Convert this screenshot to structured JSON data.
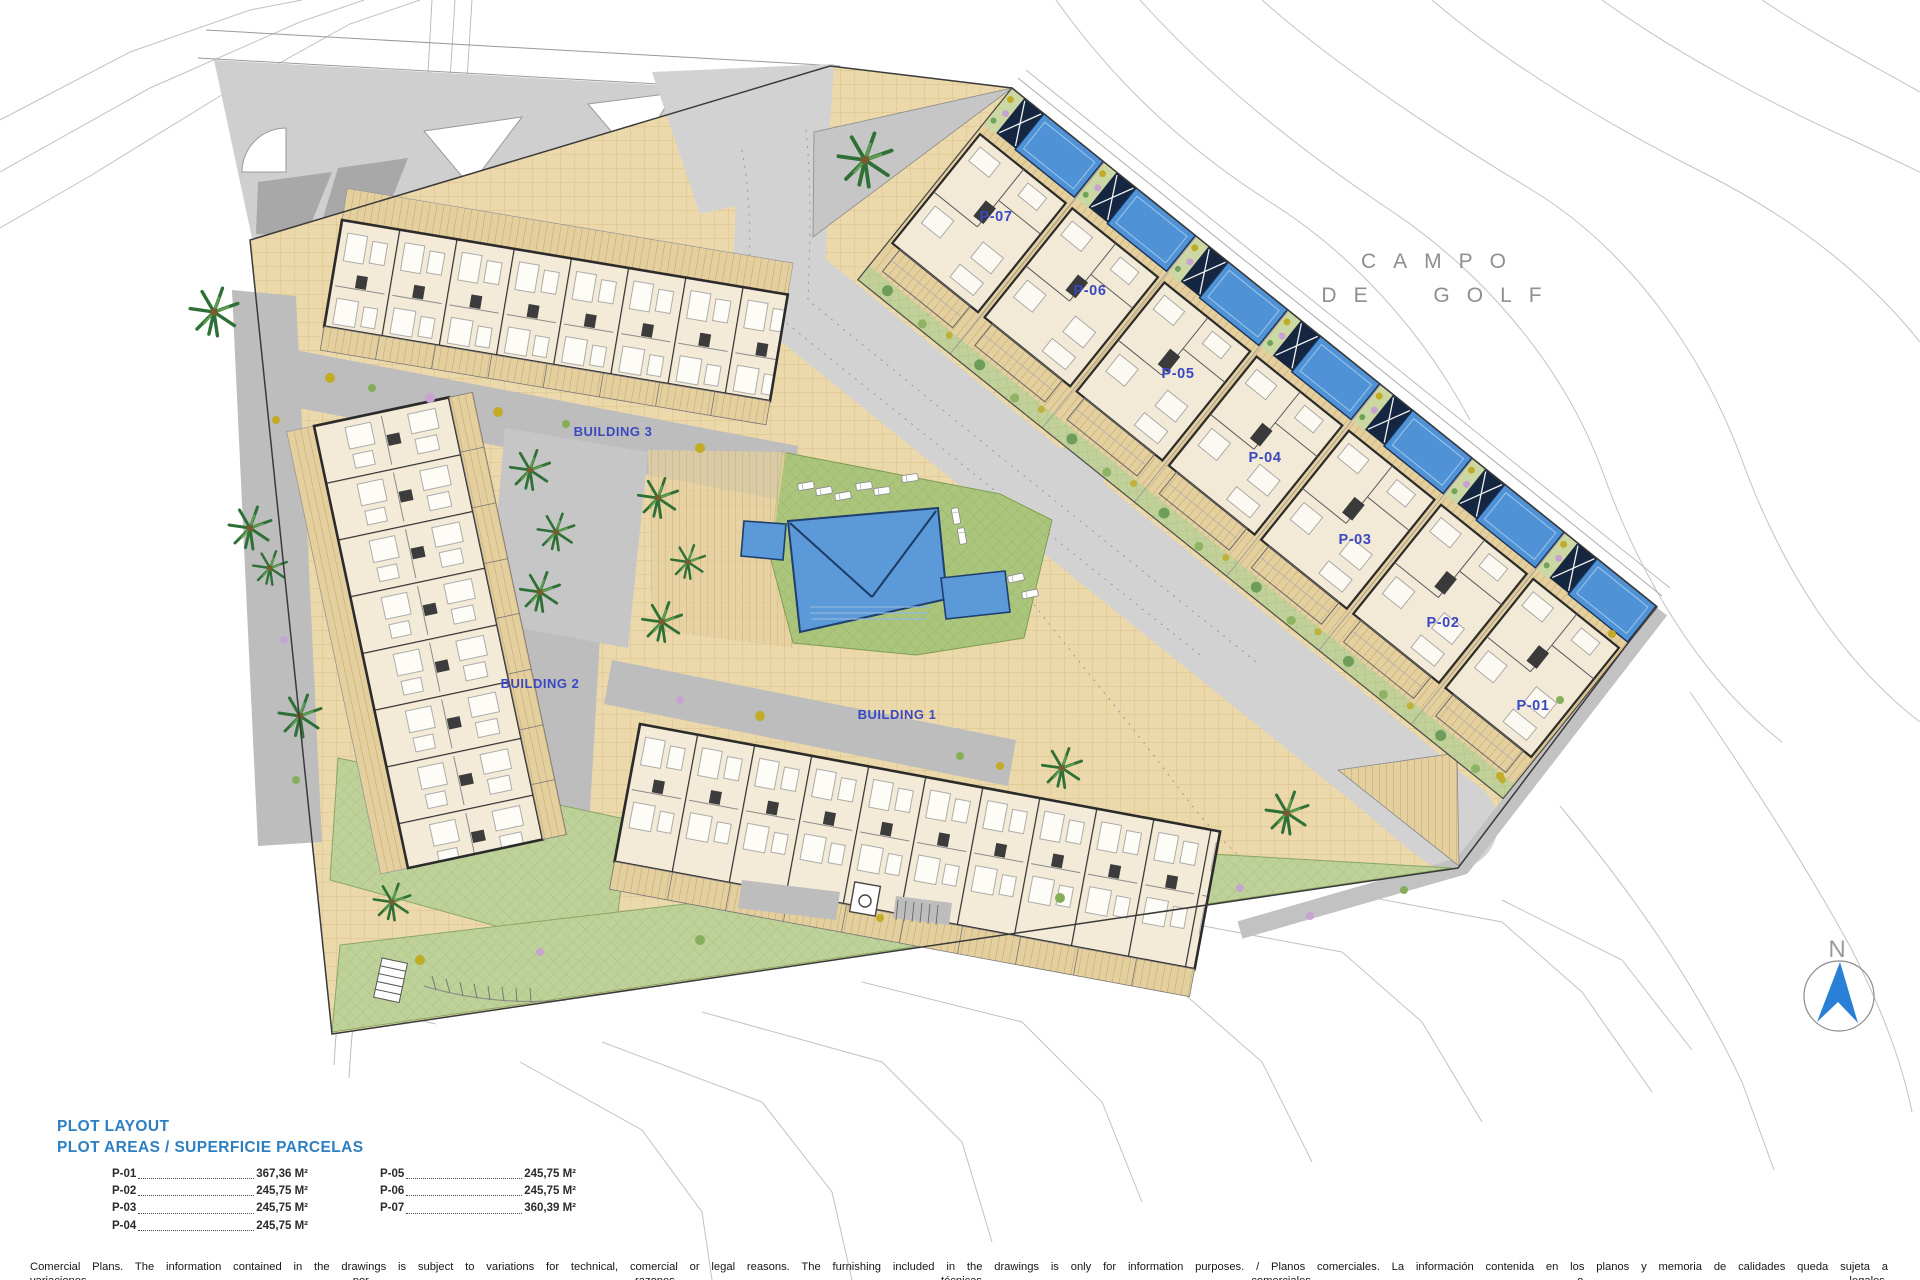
{
  "plan": {
    "golf_area_label": {
      "line1": "CAMPO",
      "line2": "DE GOLF"
    },
    "north": {
      "label": "N"
    },
    "buildings": [
      {
        "label": "BUILDING 1"
      },
      {
        "label": "BUILDING 2"
      },
      {
        "label": "BUILDING 3"
      }
    ],
    "plots": [
      {
        "label": "P-01"
      },
      {
        "label": "P-02"
      },
      {
        "label": "P-03"
      },
      {
        "label": "P-04"
      },
      {
        "label": "P-05"
      },
      {
        "label": "P-06"
      },
      {
        "label": "P-07"
      }
    ]
  },
  "legend": {
    "title": "PLOT LAYOUT",
    "subtitle": "PLOT AREAS / SUPERFICIE PARCELAS",
    "entries": [
      {
        "plot": "P-01",
        "area": "367,36 M²"
      },
      {
        "plot": "P-02",
        "area": "245,75 M²"
      },
      {
        "plot": "P-03",
        "area": "245,75 M²"
      },
      {
        "plot": "P-04",
        "area": "245,75 M²"
      },
      {
        "plot": "P-05",
        "area": "245,75 M²"
      },
      {
        "plot": "P-06",
        "area": "245,75 M²"
      },
      {
        "plot": "P-07",
        "area": "360,39 M²"
      }
    ]
  },
  "footer": {
    "disclaimer_line1": "Comercial Plans. The information contained in the drawings is subject to variations for technical, comercial or legal reasons. The furnishing included in the drawings is only for information purposes. / Planos comerciales. La información contenida en los planos y memoria de calidades queda sujeta a",
    "disclaimer_line2": "variaciones por razones técnicas, comerciales o legales."
  },
  "colors": {
    "label_blue": "#3b49c1",
    "legend_blue": "#2e7fc1",
    "pool_blue": "#4f93d6",
    "lawn_green": "#abc67c",
    "paving_tan": "#ecd9ab",
    "road_gray": "#d2d2d2",
    "north_blue": "#2a7fd6"
  }
}
